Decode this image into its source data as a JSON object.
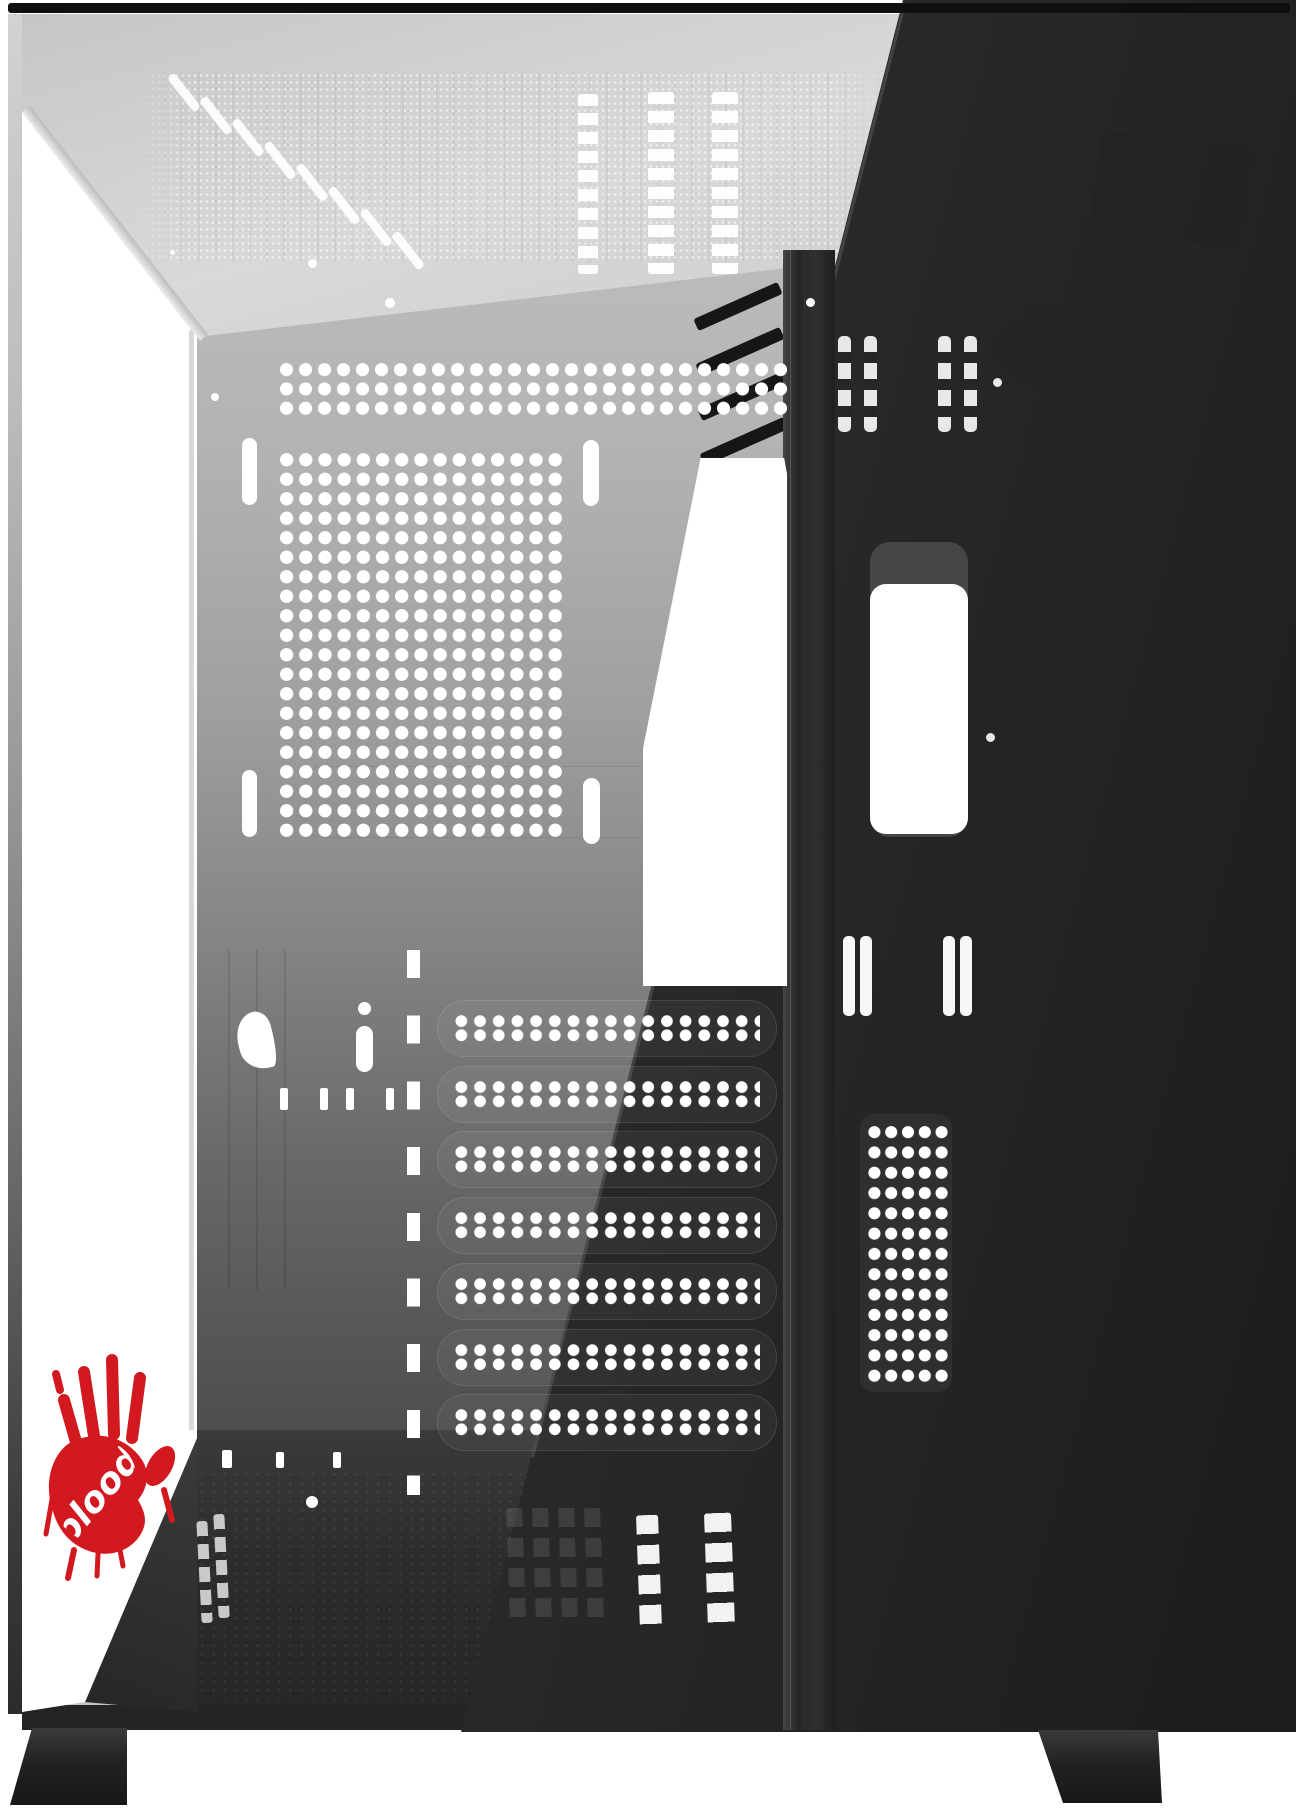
{
  "image": {
    "description": "Angled studio product render of a black mid-tower PC case with tempered-glass front and side panels on a white background",
    "view": "front-left three-quarter view showing interior through glass"
  },
  "brand": {
    "name": "Bloody",
    "logo_text": "bloody",
    "logo_style": "red handprint with white script wordmark across the palm"
  },
  "colors": {
    "background": "#ffffff",
    "panel_dark": "#2b2b2b",
    "panel_darker": "#1d1d1d",
    "glass_shade": "#383838",
    "interior_light": "#c8c8c8",
    "wall_top": "#bababa",
    "wall_bottom": "#4c4c4c",
    "floor": "#2e2e2e",
    "cutout_white": "#ffffff",
    "accent_red": "#d2191f",
    "top_edge": "#0f0f0f"
  }
}
